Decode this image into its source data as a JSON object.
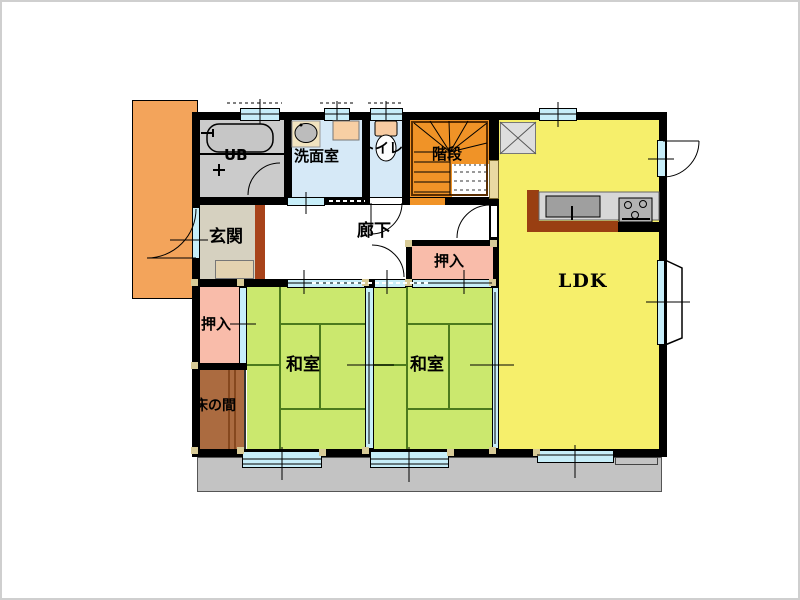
{
  "rooms": {
    "ub": {
      "label": "UB"
    },
    "washroom": {
      "label": "洗面室"
    },
    "toilet": {
      "label": "トイレ"
    },
    "stairs": {
      "label": "階段"
    },
    "genkan": {
      "label": "玄関"
    },
    "hallway": {
      "label": "廊下"
    },
    "closet_hall": {
      "label": "押入"
    },
    "closet_west": {
      "label": "押入"
    },
    "washitsu_west": {
      "label": "和室"
    },
    "washitsu_east": {
      "label": "和室"
    },
    "tokonoma": {
      "label": "床の間"
    },
    "ldk": {
      "label": "LDK"
    }
  },
  "fixtures": [
    "bathtub",
    "wash-basin",
    "washing-machine-pan",
    "toilet-bowl",
    "kitchen-sink",
    "gas-stove",
    "refrigerator-space",
    "under-stair-storage",
    "bay-window",
    "veranda-deck",
    "entrance-porch"
  ],
  "colors": {
    "wall": "#000000",
    "tatami": "#cbe86e",
    "tatami-line": "#4c7a1d",
    "ldk": "#f6ef6b",
    "closet": "#f9bcaa",
    "stairs": "#f09327",
    "porch": "#f3a45b",
    "tokonoma": "#ab6b40",
    "genkan-brown": "#a8431a",
    "veranda": "#c3c3c3",
    "water-room": "#d6e9f7",
    "window": "#c7eef9",
    "ub": "#cbcbcb",
    "genkan": "#d6d1c0",
    "genkan-step": "#e3d2b0",
    "post": "#d8cb97",
    "counter-brown": "#993f12",
    "under-stair-door": "#e9d9a2"
  }
}
